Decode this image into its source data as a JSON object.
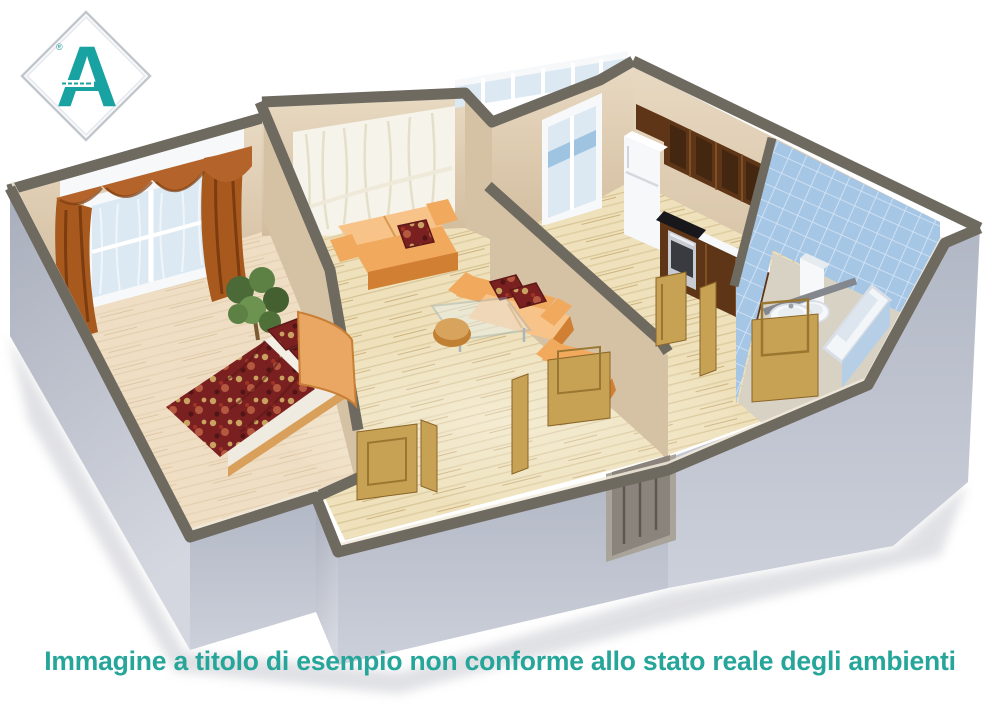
{
  "page": {
    "background": "#ffffff",
    "type": "real-estate-floor-plan-image"
  },
  "logo": {
    "letter": "A",
    "registered_mark": "®",
    "accent_color": "#18a2a2",
    "frame": "silver-diamond-outline"
  },
  "caption": {
    "text": "Immagine a titolo di esempio non conforme allo stato reale degli ambienti",
    "color": "#26a69a"
  },
  "scene": {
    "kind": "3d-isometric-apartment-cutaway-render",
    "rooms": [
      {
        "name": "bedroom",
        "items": [
          "double-bed-dark-red-floral-duvet",
          "two-patterned-pillows",
          "curved-orange-headboard",
          "window-with-rust-curtains-white-pelmet",
          "potted-plant",
          "light-wood-floor"
        ]
      },
      {
        "name": "living-room",
        "items": [
          "orange-sofa-left",
          "orange-sofa-right",
          "dark-red-cushions",
          "glass-coffee-table",
          "round-orange-stool",
          "orange-armchair",
          "floor-length-white-sheer-curtains"
        ]
      },
      {
        "name": "kitchen",
        "items": [
          "dark-wood-wall-cabinets",
          "white-refrigerator",
          "black-cooktop",
          "built-in-oven",
          "base-cabinets-with-counter",
          "balcony-door"
        ]
      },
      {
        "name": "bathroom",
        "items": [
          "light-blue-wall-tiles",
          "toilet",
          "pedestal-sink",
          "bathtub",
          "gray-towel-bar",
          "angled-corner-wall"
        ]
      },
      {
        "name": "hallway",
        "items": [
          "entrance-door",
          "open-wooden-interior-doors"
        ]
      },
      {
        "name": "balcony",
        "items": [
          "glazed-panels"
        ]
      }
    ],
    "palette": {
      "exterior_wall": "#bfc4cf",
      "wall_top_band": "#6e6a60",
      "interior_wall": "#dcc9ae",
      "floor_wood": "#ecdfba",
      "bathroom_tile": "#a6c6e6",
      "sofa_orange": "#f1a95e",
      "bed_fabric_red": "#7b2020",
      "curtain_rust": "#a8591e",
      "door_wood": "#c8a254",
      "kitchen_cabinet": "#5e3516",
      "fixture_white": "#f6f8fa"
    }
  }
}
